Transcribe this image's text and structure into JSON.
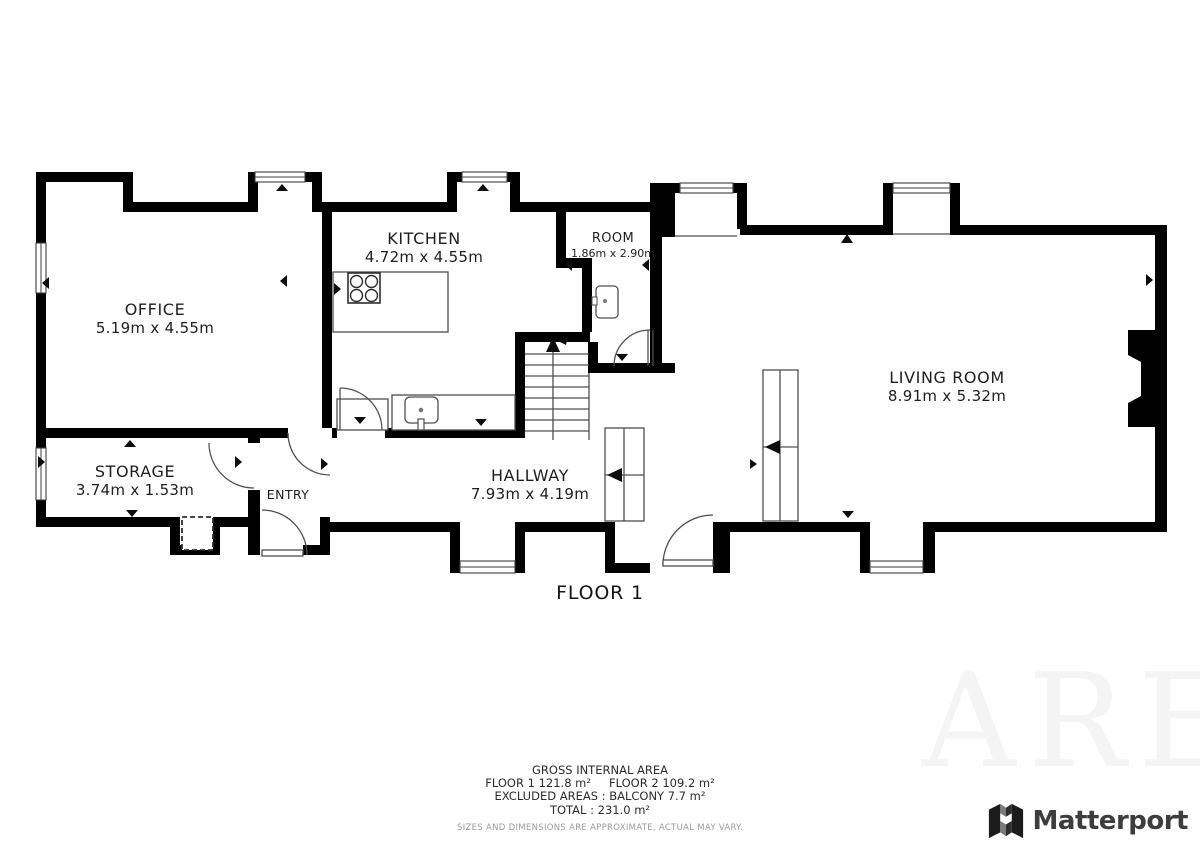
{
  "floor_label": "FLOOR 1",
  "rooms": {
    "office": {
      "name": "OFFICE",
      "dims": "5.19m x 4.55m"
    },
    "kitchen": {
      "name": "KITCHEN",
      "dims": "4.72m x 4.55m"
    },
    "room": {
      "name": "ROOM",
      "dims": "1.86m x 2.90m"
    },
    "storage": {
      "name": "STORAGE",
      "dims": "3.74m x 1.53m"
    },
    "entry": {
      "name": "ENTRY"
    },
    "hallway": {
      "name": "HALLWAY",
      "dims": "7.93m x 4.19m"
    },
    "living_room": {
      "name": "LIVING ROOM",
      "dims": "8.91m x 5.32m"
    }
  },
  "footer": {
    "title": "GROSS INTERNAL AREA",
    "floor1": "FLOOR 1 121.8 m²",
    "floor2": "FLOOR 2 109.2 m²",
    "excluded": "EXCLUDED AREAS :  BALCONY 7.7 m²",
    "total": "TOTAL :  231.0 m²",
    "disclaimer": "SIZES AND DIMENSIONS ARE APPROXIMATE, ACTUAL MAY VARY."
  },
  "branding": {
    "logo_text": "Matterport",
    "logo_icon": "matterport-m-icon"
  },
  "watermark": {
    "text": "ARE"
  },
  "colors": {
    "wall": "#000000",
    "thin_line": "#4f4f4f",
    "text": "#1e1e1e",
    "disclaimer": "#9b9b9b",
    "watermark": "#f4f4f4",
    "logo_text": "#3d3d3d"
  }
}
